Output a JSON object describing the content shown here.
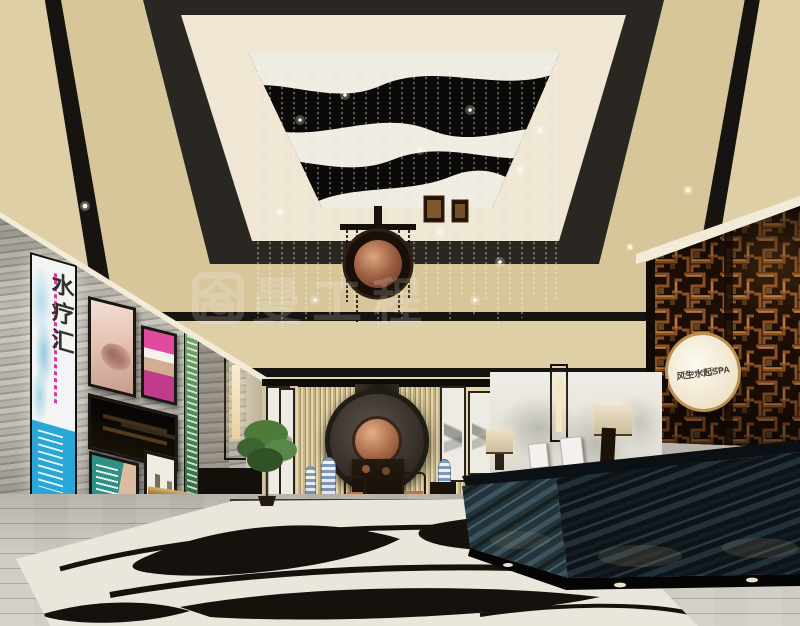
{
  "scene_title": "chinese-spa-lobby-interior-rendering",
  "signage": {
    "wall_sign": {
      "line1": "风生水起SPA",
      "line2": "FLamed SPA"
    },
    "lightbox_poster": {
      "vertical_title": "水疗汇"
    },
    "watermark": {
      "text": "合曼工程"
    }
  },
  "colors": {
    "ceiling_cream": "#e5d7b2",
    "ceiling_black": "#161310",
    "lattice_wood": "#8a5126",
    "sign_background": "#fdfaf2",
    "copper_disc": "#a86a48",
    "poster_blue": "#2ba6d8",
    "poster_magenta": "#e14b9e",
    "poster_teal": "#2f9186",
    "desk_marble": "#0d1318",
    "floor_grey": "#ccc7be",
    "slat_wall": "#c6b488"
  }
}
